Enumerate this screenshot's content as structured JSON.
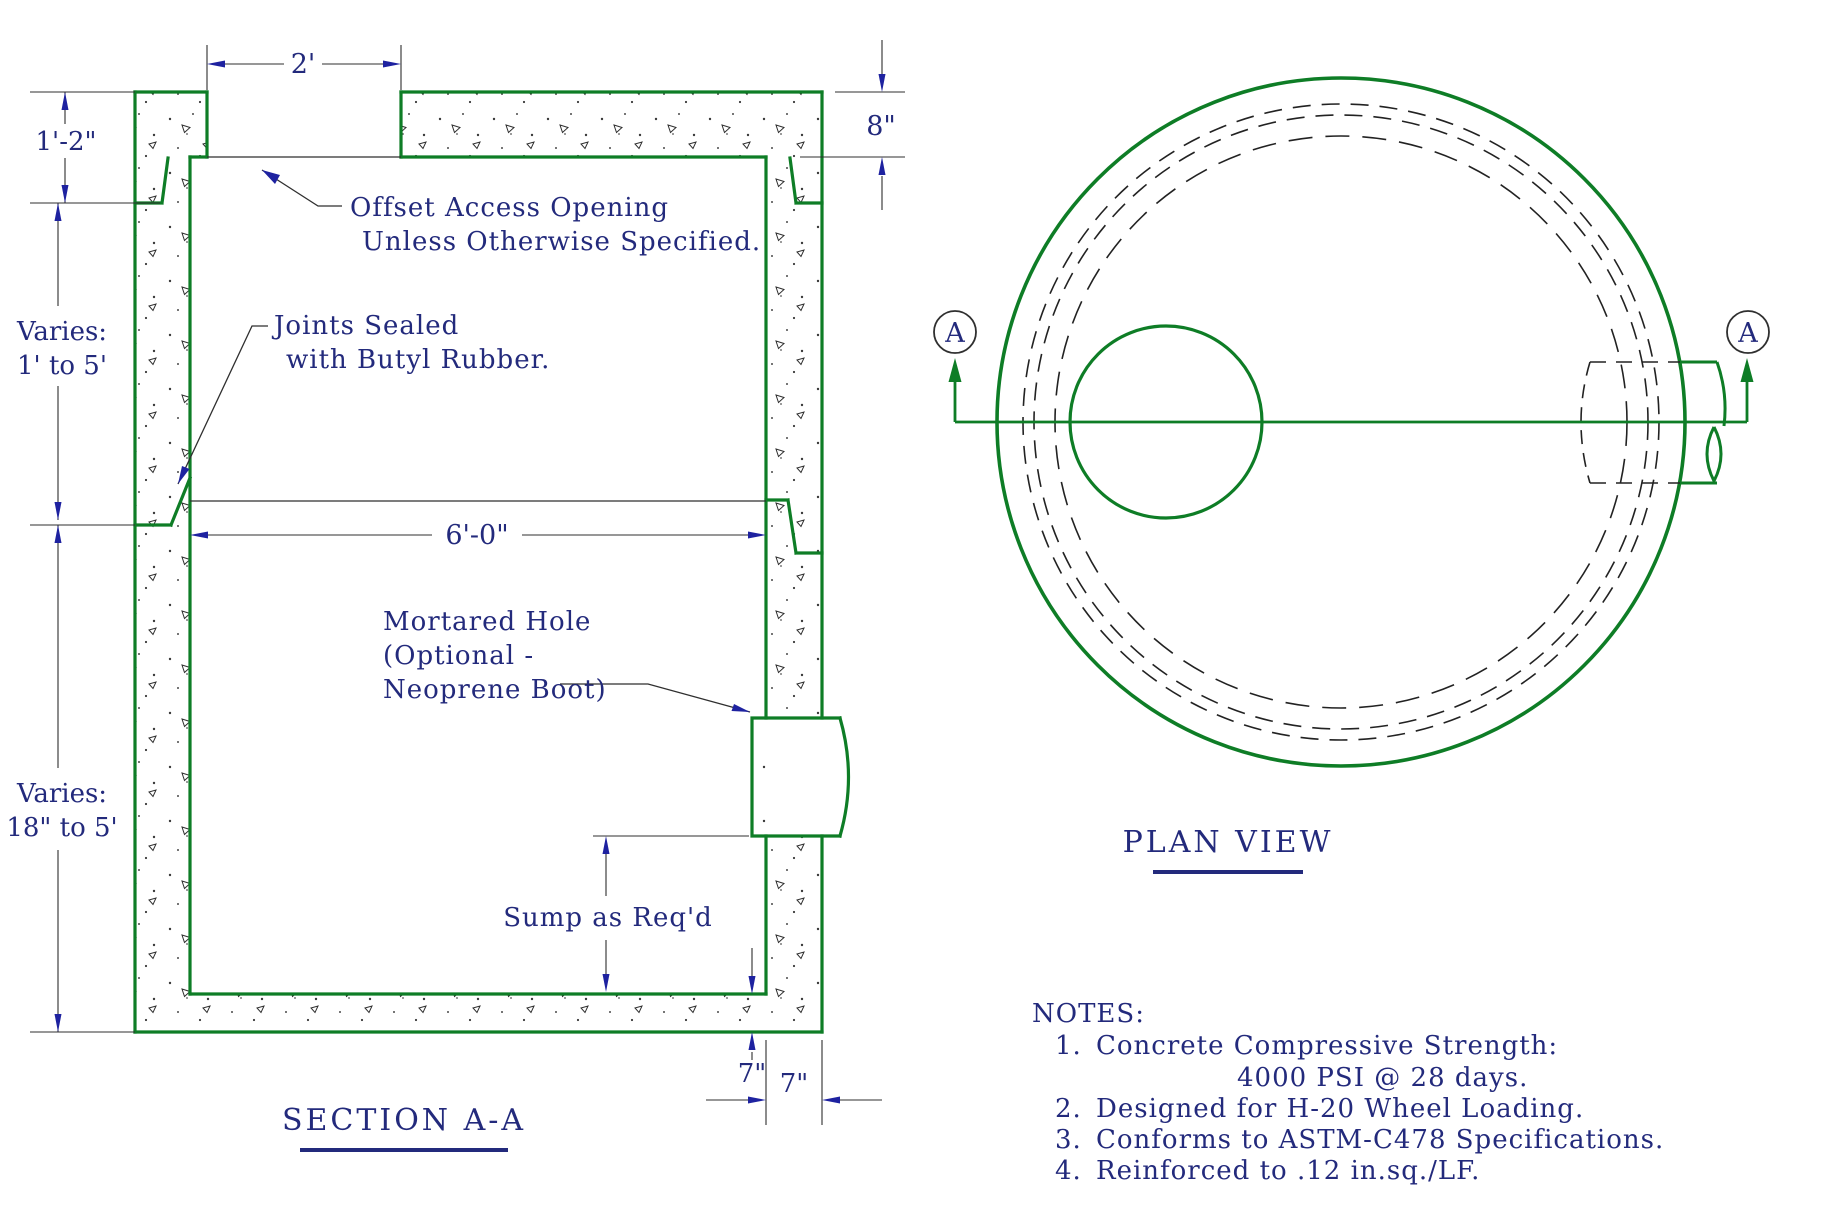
{
  "colors": {
    "drawing_green": "#0e7d26",
    "text_navy": "#232a7c",
    "arrow_navy": "#1e22a0",
    "thin_line": "#2f2f2f"
  },
  "section": {
    "title": "SECTION A-A",
    "dims": {
      "opening_width": "2'",
      "collar_height": "1'-2\"",
      "lid_thickness": "8\"",
      "riser_height_1": "Varies:",
      "riser_height_2": "1' to 5'",
      "base_height_1": "Varies:",
      "base_height_2": "18\" to 5'",
      "inner_width": "6'-0\"",
      "slab_thickness": "7\"",
      "wall_thickness": "7\""
    },
    "labels": {
      "offset_opening_1": "Offset Access Opening",
      "offset_opening_2": "Unless Otherwise Specified.",
      "joints_1": "Joints Sealed",
      "joints_2": "with Butyl Rubber.",
      "mortared_1": "Mortared Hole",
      "mortared_2": "(Optional -",
      "mortared_3": "Neoprene Boot)",
      "sump": "Sump as Req'd"
    }
  },
  "plan": {
    "title": "PLAN VIEW",
    "marker": "A"
  },
  "notes": {
    "heading": "NOTES:",
    "items": [
      {
        "num": "1.",
        "line1": "Concrete Compressive Strength:",
        "line2": "4000 PSI @ 28 days."
      },
      {
        "num": "2.",
        "line1": "Designed for H-20 Wheel Loading.",
        "line2": ""
      },
      {
        "num": "3.",
        "line1": "Conforms to ASTM-C478 Specifications.",
        "line2": ""
      },
      {
        "num": "4.",
        "line1": "Reinforced to .12 in.sq./LF.",
        "line2": ""
      }
    ]
  }
}
